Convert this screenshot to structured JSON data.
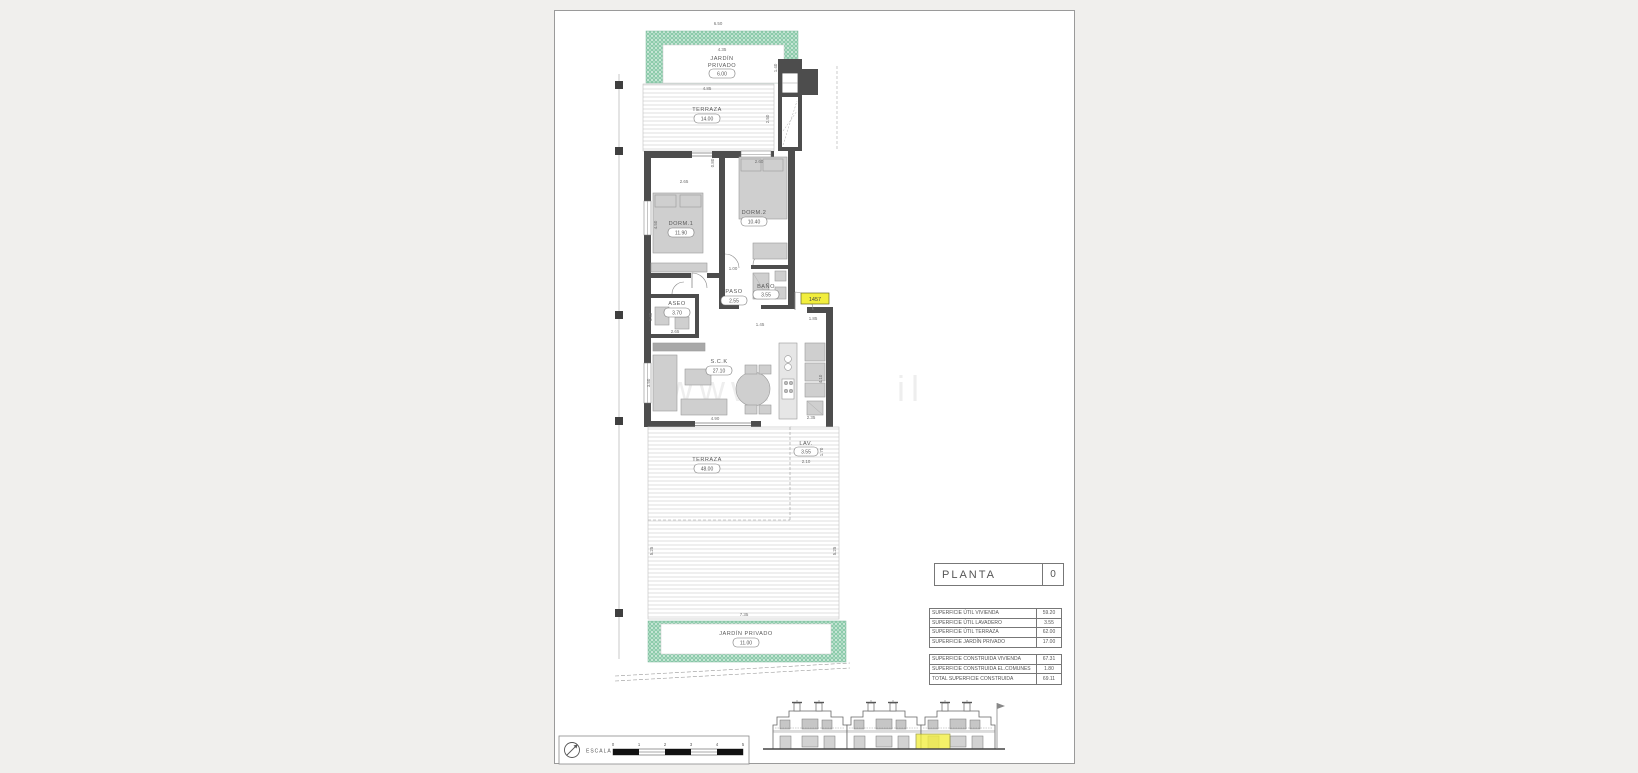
{
  "title_block": {
    "label": "PLANTA",
    "value": "0"
  },
  "tables": {
    "util": {
      "rows": [
        {
          "label": "SUPERFICIE ÚTIL VIVIENDA",
          "value": "59.20"
        },
        {
          "label": "SUPERFICIE ÚTIL LAVADERO",
          "value": "3.55"
        },
        {
          "label": "SUPERFICIE ÚTIL TERRAZA",
          "value": "62.00"
        },
        {
          "label": "SUPERFICIE JARDÍN PRIVADO",
          "value": "17.00"
        }
      ]
    },
    "construida": {
      "rows": [
        {
          "label": "SUPERFICIE CONSTRUIDA VIVIENDA",
          "value": "67.31"
        },
        {
          "label": "SUPERFICIE CONSTRUIDA EL.COMUNES",
          "value": "1.80"
        },
        {
          "label": "TOTAL SUPERFICIE CONSTRUIDA",
          "value": "69.11"
        }
      ]
    }
  },
  "plan": {
    "unit_tag": "1457",
    "rooms": {
      "garden_top": {
        "line1": "JARDÍN",
        "line2": "PRIVADO",
        "area": "6.00"
      },
      "terrace_top": {
        "label": "TERRAZA",
        "area": "14.00"
      },
      "dorm1": {
        "label": "DORM.1",
        "area": "11.90"
      },
      "dorm2": {
        "label": "DORM.2",
        "area": "10.40"
      },
      "paso": {
        "label": "PASO",
        "area": "2.55"
      },
      "bano": {
        "label": "BAÑO",
        "area": "3.55"
      },
      "aseo": {
        "label": "ASEO",
        "area": "3.70"
      },
      "sck": {
        "label": "S.C.K",
        "area": "27.10"
      },
      "lav": {
        "label": "LAV.",
        "area": "3.55"
      },
      "terrace_main": {
        "label": "TERRAZA",
        "area": "48.00"
      },
      "garden_bottom": {
        "label": "JARDÍN PRIVADO",
        "area": "11.00"
      }
    },
    "dims": {
      "plot_top": "6.50",
      "garden_top_w": "4.35",
      "garden_top_r": "1.40",
      "terrace_top_w": "4.85",
      "terrace_top_r": "2.50",
      "dorm1_w": "2.65",
      "dorm1_h": "4.50",
      "dorm2_w": "2.60",
      "dorm2_wall": "0.80",
      "paso_w": "1.00",
      "bano_w": "1.45",
      "aseo_h": "1.40",
      "aseo_w": "2.65",
      "entry": "1.85",
      "sck_h": "3.50",
      "sck_w": "4.90",
      "sck_r": "4.10",
      "sck_door": "2.35",
      "lav_w": "2.10",
      "lav_r": "1.70",
      "terr_l": "5.25",
      "terr_r": "5.25",
      "terr_w": "7.35"
    }
  },
  "scale_bar": {
    "label": "ESCALA :",
    "ticks": [
      "0",
      "1",
      "2",
      "3",
      "4",
      "5"
    ]
  },
  "watermark": {
    "part1": "www.c",
    "part2": "il"
  },
  "colors": {
    "wall": "#4d4d4d",
    "green": "#8ccbab",
    "yellow": "#f2ee3e",
    "paper": "#ffffff",
    "background": "#f0efed"
  }
}
